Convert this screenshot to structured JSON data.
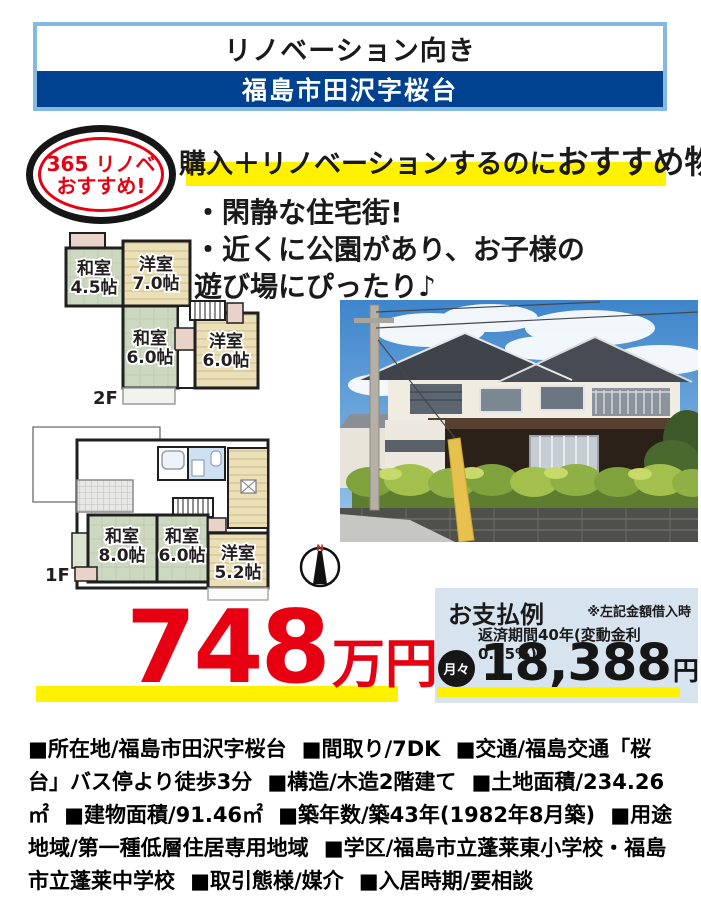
{
  "top_banner": {
    "tagline": "リノベーション向き",
    "location": "福島市田沢字桜台"
  },
  "badge": {
    "line1": "365 リノベ",
    "line2": "おすすめ!"
  },
  "headline": {
    "normal": "購入＋リノベーションするのに",
    "emphasis": "おすすめ物件!"
  },
  "features": [
    "・閑静な住宅街!",
    "・近くに公園があり、お子様の",
    "遊び場にぴったり♪"
  ],
  "floorplans": {
    "second": {
      "label": "2F",
      "rooms": [
        {
          "name": "和室",
          "size": "4.5帖"
        },
        {
          "name": "洋室",
          "size": "7.0帖"
        },
        {
          "name": "和室",
          "size": "6.0帖"
        },
        {
          "name": "洋室",
          "size": "6.0帖"
        }
      ]
    },
    "first": {
      "label": "1F",
      "rooms": [
        {
          "name": "和室",
          "size": "8.0帖"
        },
        {
          "name": "和室",
          "size": "6.0帖"
        },
        {
          "name": "洋室",
          "size": "5.2帖"
        }
      ]
    }
  },
  "compass": {
    "label": "N"
  },
  "price": {
    "amount": "748",
    "unit": "万円"
  },
  "payment": {
    "title": "お支払例",
    "note1": "※左記金額借入時",
    "note2": "返済期間40年(変動金利0.85%)",
    "monthly_label": "月々",
    "monthly_amount": "18,388",
    "monthly_unit": "円"
  },
  "details": [
    "■所在地/福島市田沢字桜台",
    "■間取り/7DK",
    "■交通/福島交通「桜台」バス停より徒歩3分",
    "■構造/木造2階建て",
    "■土地面積/234.26㎡",
    "■建物面積/91.46㎡",
    "■築年数/築43年(1982年8月築)",
    "■用途地域/第一種低層住居専用地域",
    "■学区/福島市立蓬莱東小学校・福島市立蓬莱中学校",
    "■取引態様/媒介",
    "■入居時期/要相談"
  ],
  "colors": {
    "navy": "#004190",
    "light_blue_border": "#86b9e2",
    "accent_red": "#e60012",
    "highlight_yellow": "#fff100",
    "payment_bg": "#d8e3f0"
  }
}
